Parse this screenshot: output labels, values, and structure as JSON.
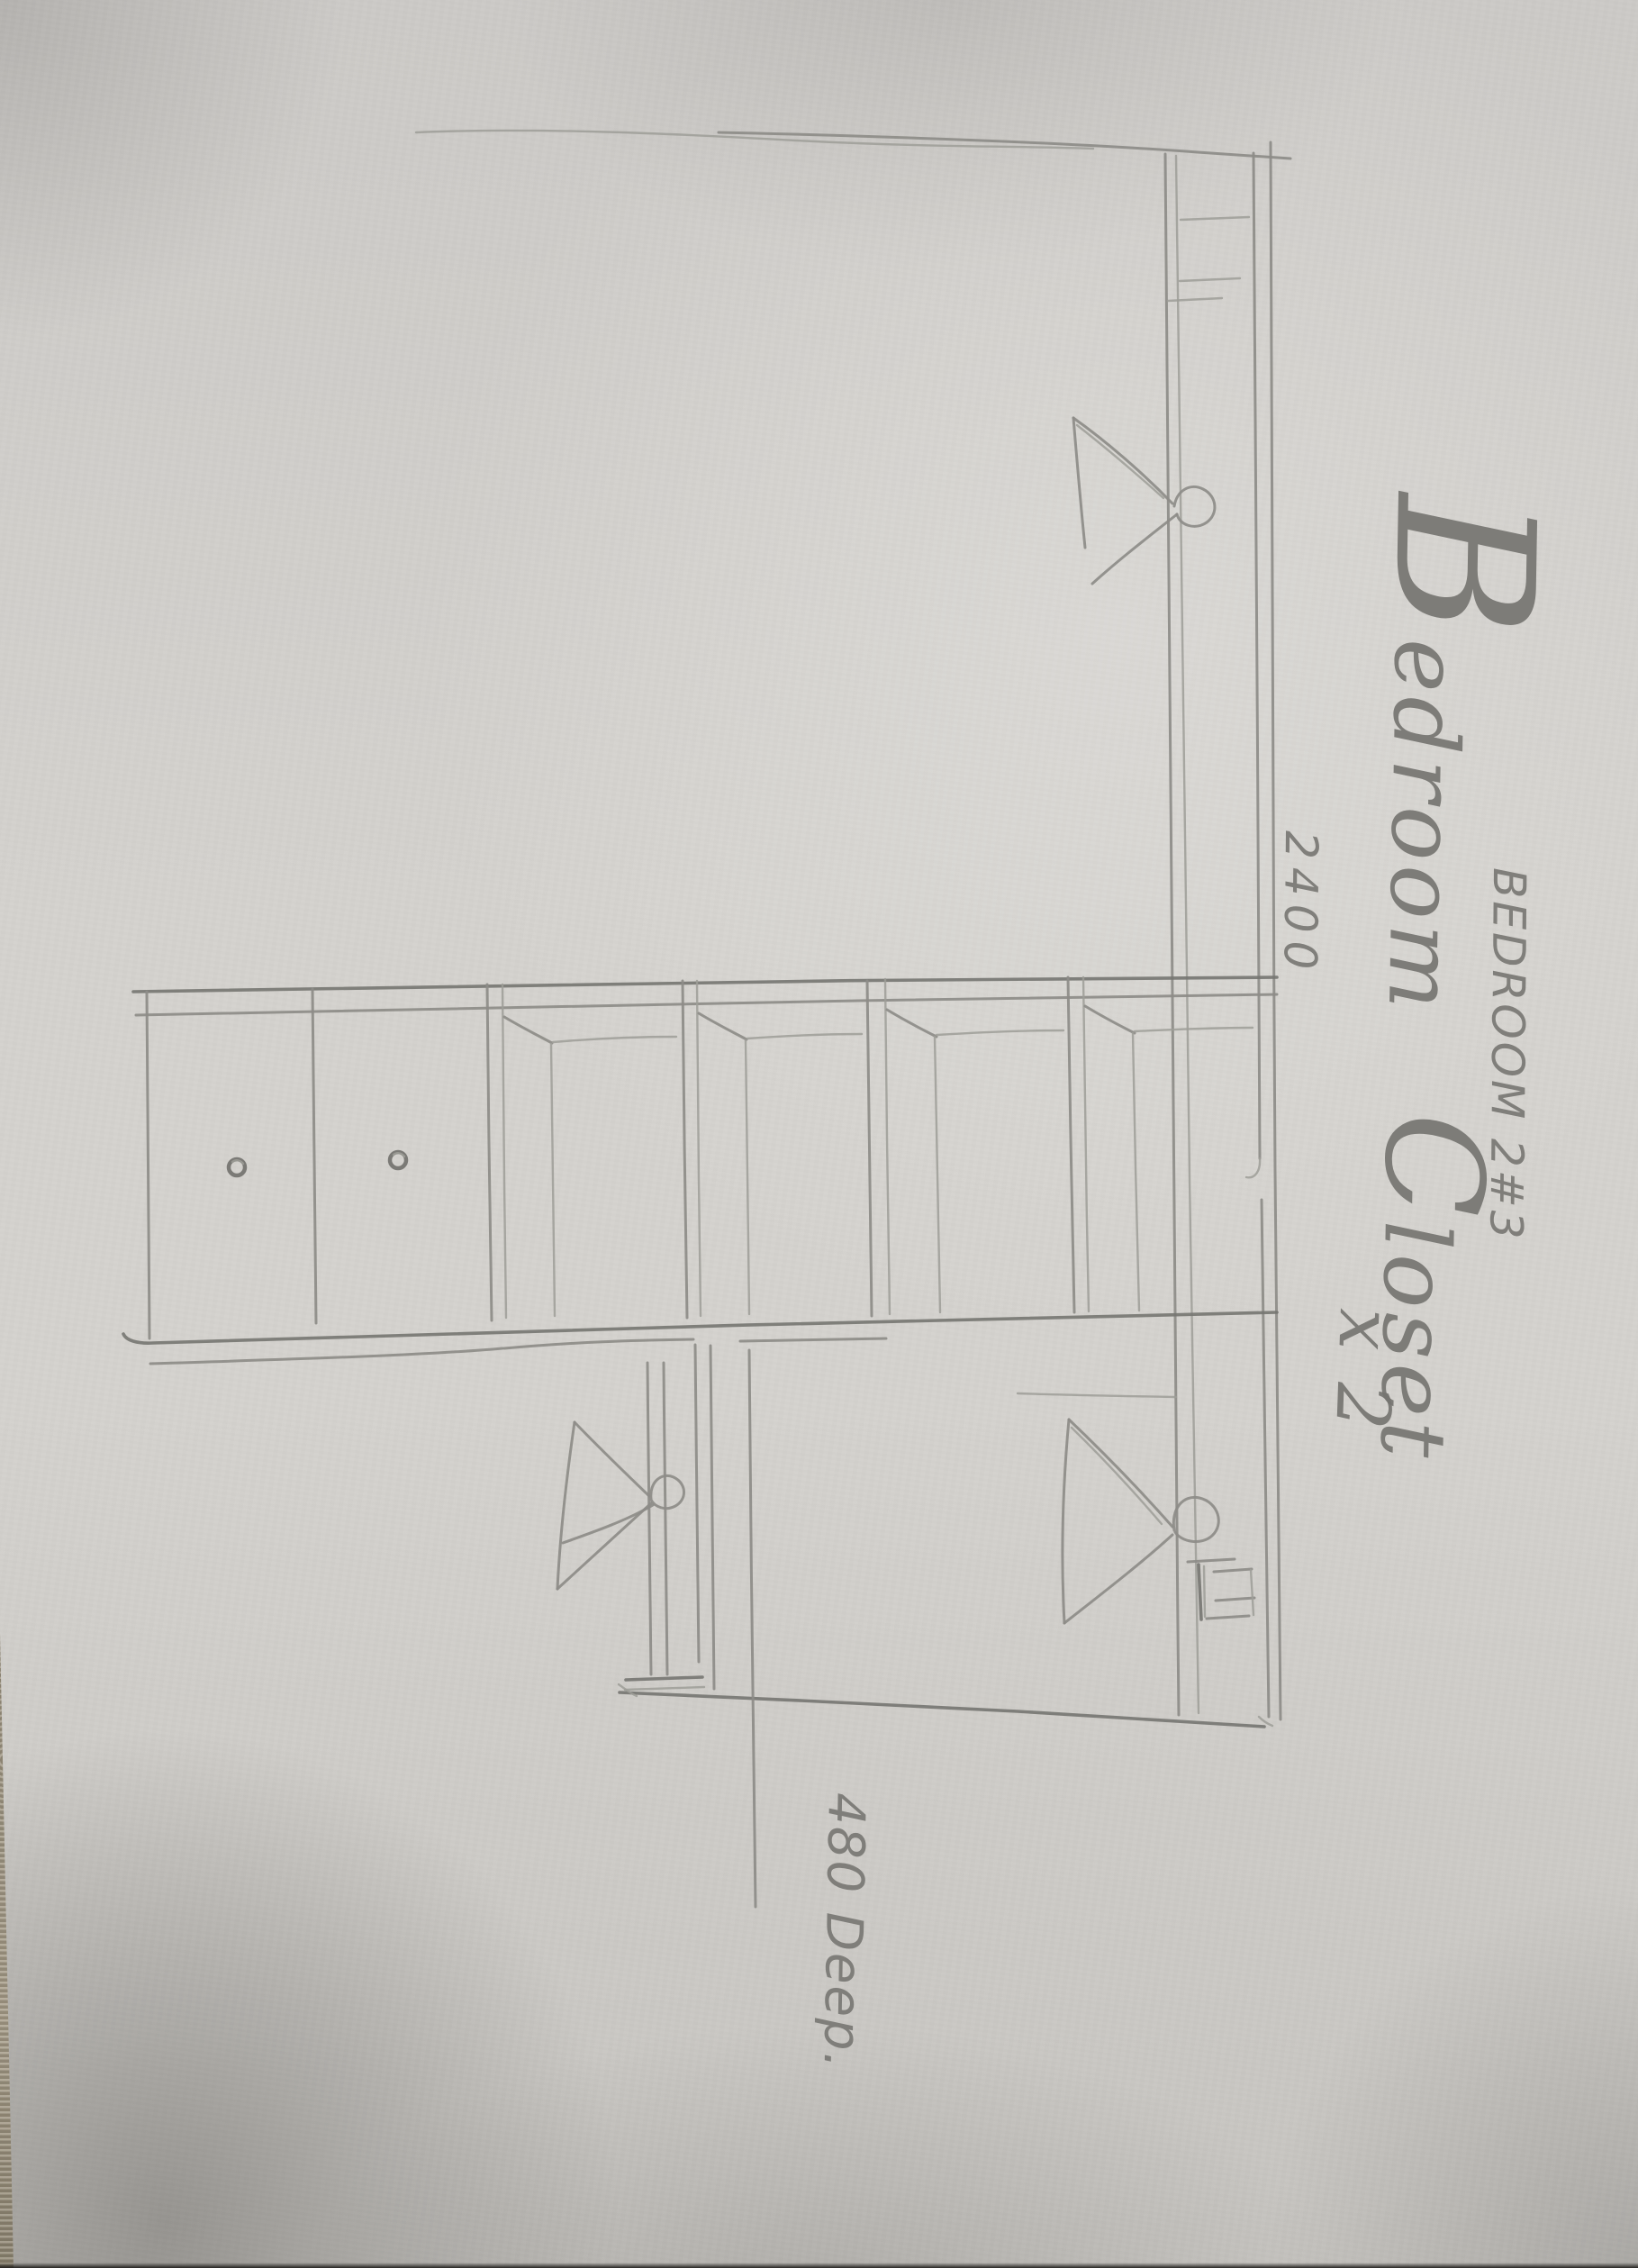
{
  "sketch": {
    "room_label": "BEDROOM 2#3",
    "title": {
      "part_initial_b": "B",
      "part_edroom": "edroom",
      "part_initial_c": "C",
      "part_loset": "loset",
      "quantity_note": "x 2",
      "full_text": "Bedroom Closet x 2"
    },
    "dimensions": {
      "overall": "2400",
      "depth": "480 Deep."
    },
    "icons": {
      "hanger_symbol": "triangle-with-hook-clothes-hanger",
      "knob_symbol": "scribbled-door-knob-dot"
    },
    "colors": {
      "paper": "#d4d2ce",
      "paper_top": "#cccac7",
      "paper_low": "#c6c4c0",
      "paper_shadow": "#a9a6a1",
      "table_edge": "#a89e8a",
      "pencil": "#8d8c88",
      "pencil_light": "#9e9d98",
      "pencil_dark": "#767571"
    }
  }
}
